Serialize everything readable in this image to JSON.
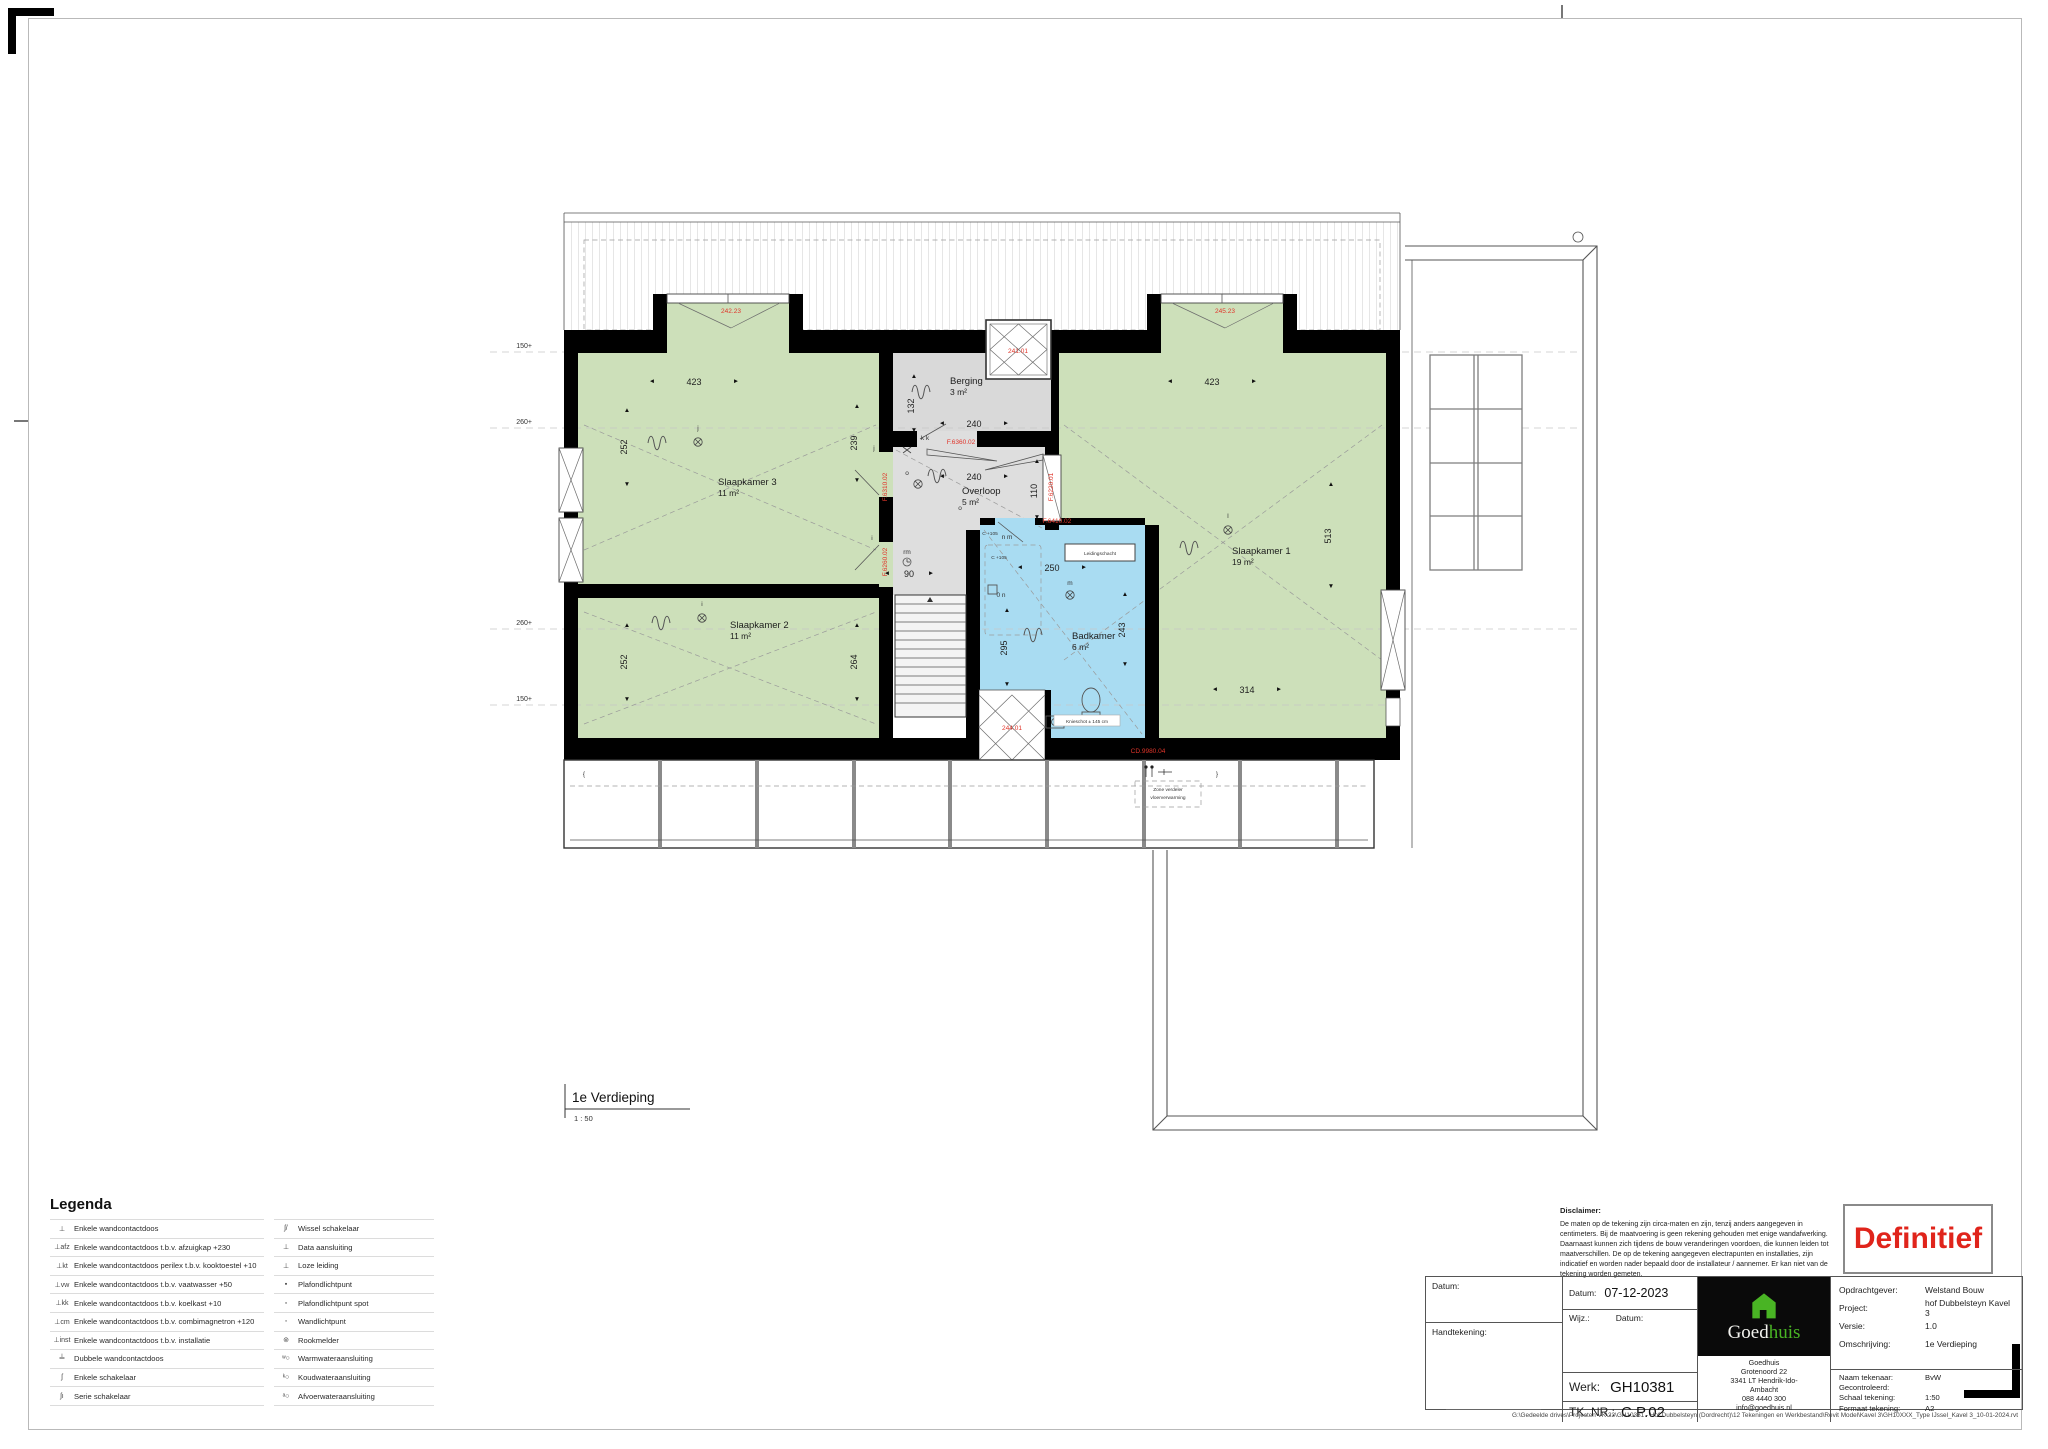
{
  "icons": {
    "up": "▲",
    "down": "▼",
    "left": "◄",
    "right": "►",
    "stair_up": "△"
  },
  "plan": {
    "title": "1e Verdieping",
    "scale": "1 : 50",
    "levels": {
      "l1": "150+",
      "l2": "260+",
      "l3": "260+",
      "l4": "150+"
    },
    "rooms": {
      "sk3": {
        "name": "Slaapkamer 3",
        "area": "11 m²"
      },
      "sk2": {
        "name": "Slaapkamer 2",
        "area": "11 m²"
      },
      "sk1": {
        "name": "Slaapkamer 1",
        "area": "19 m²"
      },
      "berging": {
        "name": "Berging",
        "area": "3 m²"
      },
      "overloop": {
        "name": "Overloop",
        "area": "5 m²"
      },
      "badkamer": {
        "name": "Badkamer",
        "area": "6 m²"
      }
    },
    "dims": {
      "sk3_w": "423",
      "sk1_w": "423",
      "berging_w": "240",
      "berging_h": "132",
      "wall_239": "239",
      "sk3_h": "252",
      "sk2_h": "252",
      "sk2_r": "264",
      "overloop_w": "240",
      "overloop_r": "110",
      "stair_w": "90",
      "bad_w": "250",
      "bad_h": "295",
      "bad_r": "243",
      "sk1_h": "513",
      "sk1_b": "314"
    },
    "red_labels": {
      "w_left": "242.23",
      "w_right": "245.23",
      "shaft": "241.01",
      "w_bottom": "244.01",
      "door_berging": "F.6360.02",
      "win_overloop_l": "F.6310.02",
      "win_overloop_r": "F.6220.01",
      "win_corridor": "F.6260.02",
      "door_bad": "F.6410.02",
      "code_bottom": "CD.9980.04"
    },
    "notes": {
      "knieschot": "Knieschot ± 145 cm",
      "zone1": "Zone verdeler",
      "zone2": "vloerverwarming",
      "leidingschacht": "Leidingschacht",
      "c105a": "C +105",
      "c105b": "C +105"
    },
    "letters": {
      "j1": "j",
      "j2": "j",
      "i1": "i",
      "i2": "i",
      "kk": "k  k",
      "o1": "o",
      "o2": "o",
      "nm": "n  m",
      "m": "m",
      "on": "0 n",
      "rm": "rm",
      "l1": "l"
    }
  },
  "legend": {
    "title": "Legenda",
    "col1": [
      {
        "sym": "⊥",
        "label": "Enkele wandcontactdoos"
      },
      {
        "sym": "⊥afz",
        "label": "Enkele wandcontactdoos t.b.v. afzuigkap +230"
      },
      {
        "sym": "⊥kt",
        "label": "Enkele wandcontactdoos perilex t.b.v. kooktoestel +10"
      },
      {
        "sym": "⊥vw",
        "label": "Enkele wandcontactdoos t.b.v. vaatwasser +50"
      },
      {
        "sym": "⊥kk",
        "label": "Enkele wandcontactdoos t.b.v. koelkast +10"
      },
      {
        "sym": "⊥cm",
        "label": "Enkele wandcontactdoos t.b.v. combimagnetron +120"
      },
      {
        "sym": "⊥inst",
        "label": "Enkele wandcontactdoos t.b.v. installatie"
      },
      {
        "sym": "╧",
        "label": "Dubbele wandcontactdoos"
      },
      {
        "sym": "ʃ",
        "label": "Enkele schakelaar"
      },
      {
        "sym": "ʃı",
        "label": "Serie schakelaar"
      }
    ],
    "col2": [
      {
        "sym": "ʃ/",
        "label": "Wissel schakelaar"
      },
      {
        "sym": "⊥",
        "label": "Data aansluiting"
      },
      {
        "sym": "⊥",
        "label": "Loze leiding"
      },
      {
        "sym": "▪",
        "label": "Plafondlichtpunt"
      },
      {
        "sym": "▫",
        "label": "Plafondlichtpunt spot"
      },
      {
        "sym": "◦",
        "label": "Wandlichtpunt"
      },
      {
        "sym": "⊚",
        "label": "Rookmelder"
      },
      {
        "sym": "ʷ○",
        "label": "Warmwateraansluiting"
      },
      {
        "sym": "ᵏ○",
        "label": "Koudwateraansluiting"
      },
      {
        "sym": "ᵃ○",
        "label": "Afvoerwateraansluiting"
      }
    ]
  },
  "disclaimer": {
    "title": "Disclaimer:",
    "body": "De maten op de tekening zijn circa-maten en zijn, tenzij anders aangegeven in centimeters. Bij de maatvoering is geen rekening gehouden met enige wandafwerking. Daarnaast kunnen zich tijdens de bouw veranderingen voordoen, die kunnen leiden tot maatverschillen. De op de tekening aangegeven electrapunten en installaties, zijn indicatief en worden nader bepaald door de installateur / aannemer. Er kan niet van de tekening worden gemeten."
  },
  "stamp": {
    "text": "Definitief"
  },
  "titleblock": {
    "datum_label": "Datum:",
    "handtekening_label": "Handtekening:",
    "datum2_label": "Datum:",
    "datum_value": "07-12-2023",
    "wijz_label": "Wijz.:",
    "wijz_datum_label": "Datum:",
    "werk_label": "Werk:",
    "werk_value": "GH10381",
    "tknr_label": "TK. NR.:",
    "tknr_value": "C.P.02",
    "rows": [
      {
        "label": "Opdrachtgever:",
        "value": "Welstand Bouw"
      },
      {
        "label": "Project:",
        "value": "hof Dubbelsteyn Kavel 3"
      },
      {
        "label": "Versie:",
        "value": "1.0"
      },
      {
        "label": "Omschrijving:",
        "value": "1e Verdieping"
      }
    ],
    "rows2": [
      {
        "label": "Naam tekenaar:",
        "value": "BvW"
      },
      {
        "label": "Gecontroleerd:",
        "value": ""
      },
      {
        "label": "Schaal tekening:",
        "value": "1:50"
      },
      {
        "label": "Formaat tekening:",
        "value": "A2"
      }
    ],
    "logo": {
      "goed": "Goed",
      "huis": "huis",
      "address": [
        "Goedhuis",
        "Grotenoord 22",
        "3341 LT  Hendrik-Ido-",
        "Ambacht",
        "088 4440 300",
        "info@goedhuis.nl"
      ]
    }
  },
  "footer_path": "G:\\Gedeelde drives\\Projecten VK\\23\\GH10381 - Hof Dubbelsteyn (Dordrecht)\\12 Tekeningen en Werkbestand\\Revit Model\\Kavel 3\\GH10XXX_Type IJssel_Kavel 3_10-01-2024.rvt"
}
